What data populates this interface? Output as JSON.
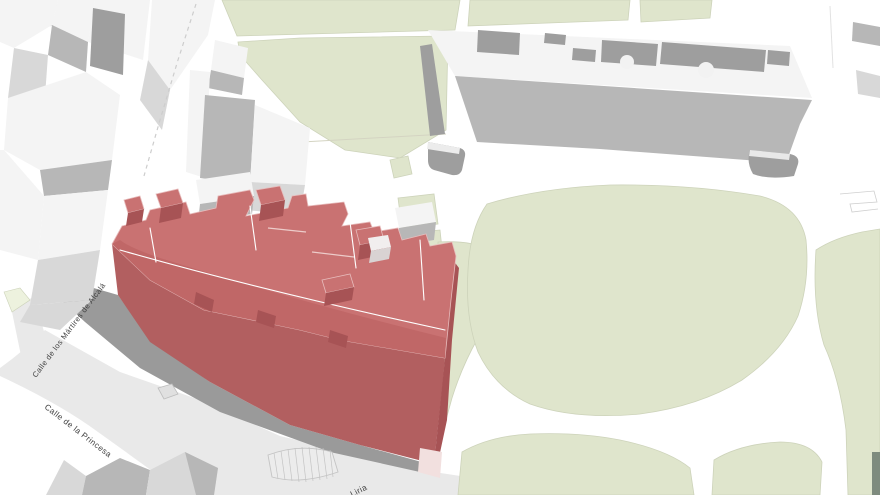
{
  "map": {
    "labels": {
      "street_martires": "Calle de los Mártires de Alcalá",
      "street_princesa": "Calle de la Princesa",
      "street_liria": "Liria"
    }
  },
  "colors": {
    "background": "#ffffff",
    "plaza_gray": "#e9e9e9",
    "shadow_gray": "#9a9a9a",
    "park_green": "#dfe5cc",
    "park_green_pale": "#edf2de",
    "park_outline": "#cdd3ba",
    "building_white": "#f4f4f4",
    "building_face_light": "#d8d8d8",
    "building_face_mid": "#b7b7b7",
    "building_face_dark": "#9e9e9e",
    "highlight_roof": "#c97272",
    "highlight_roof_tier": "#c06767",
    "highlight_facade": "#b25f60",
    "highlight_side": "#a75355",
    "highlight_seam": "#ffffff",
    "ground_pink": "#f2e0df",
    "label_color": "#3f3f3f"
  }
}
